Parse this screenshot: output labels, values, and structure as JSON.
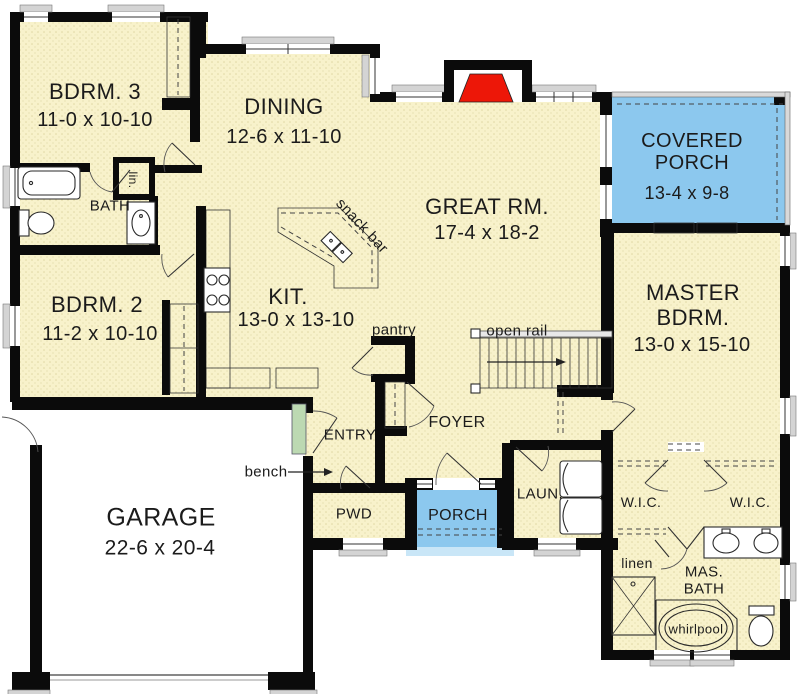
{
  "colors": {
    "floor": "#F8F2CB",
    "floor_dot": "#DFD7A4",
    "wall": "#0B0B0B",
    "porch_blue": "#8CC8EE",
    "porch_apron": "#C9E6F7",
    "fireplace_red": "#ED1708",
    "bench_green": "#BCD9B2",
    "text": "#1B1B1B"
  },
  "rooms": {
    "bdrm3": {
      "name": "BDRM. 3",
      "dims": "11-0 x 10-10"
    },
    "dining": {
      "name": "DINING",
      "dims": "12-6 x 11-10"
    },
    "great_room": {
      "name": "GREAT RM.",
      "dims": "17-4 x 18-2"
    },
    "covered_porch": {
      "name_line1": "COVERED",
      "name_line2": "PORCH",
      "dims": "13-4 x 9-8"
    },
    "bath": {
      "name": "BATH"
    },
    "bdrm2": {
      "name": "BDRM. 2",
      "dims": "11-2 x 10-10"
    },
    "kitchen": {
      "name": "KIT.",
      "dims": "13-0 x 13-10"
    },
    "master_bdrm": {
      "name_line1": "MASTER",
      "name_line2": "BDRM.",
      "dims": "13-0 x 15-10"
    },
    "garage": {
      "name": "GARAGE",
      "dims": "22-6 x 20-4"
    },
    "foyer": {
      "name": "FOYER"
    },
    "entry": {
      "name": "ENTRY"
    },
    "pwd": {
      "name": "PWD"
    },
    "porch": {
      "name": "PORCH"
    },
    "laundry": {
      "name": "LAUN."
    },
    "wic_left": {
      "name": "W.I.C."
    },
    "wic_right": {
      "name": "W.I.C."
    },
    "linen": {
      "name": "linen"
    },
    "master_bath": {
      "name_line1": "MAS.",
      "name_line2": "BATH"
    }
  },
  "annotations": {
    "snack_bar": "snack bar",
    "pantry": "pantry",
    "open_rail": "open rail",
    "bench": "bench",
    "lin_closet": "lin.",
    "whirlpool": "whirlpool"
  }
}
